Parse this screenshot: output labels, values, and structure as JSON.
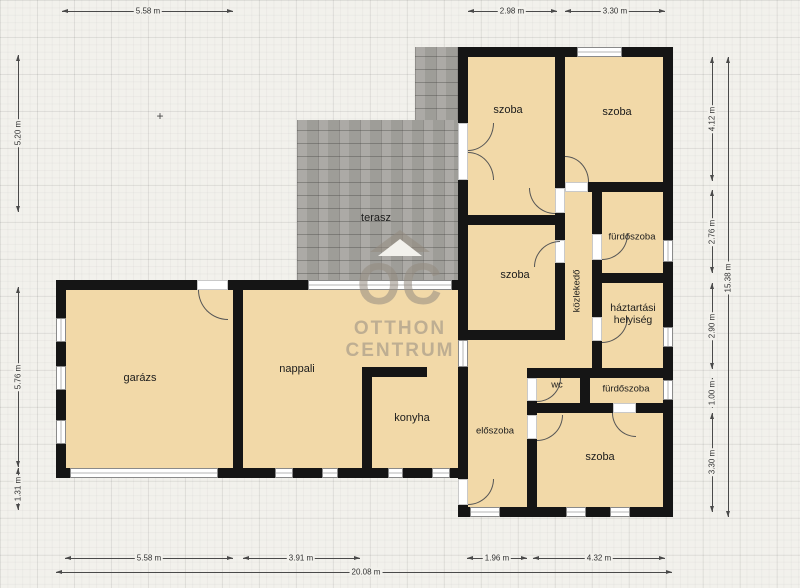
{
  "rooms": {
    "garazs": "garázs",
    "nappali": "nappali",
    "konyha": "konyha",
    "terasz": "terasz",
    "szoba_top_left": "szoba",
    "szoba_top_right": "szoba",
    "szoba_middle": "szoba",
    "szoba_bottom_right": "szoba",
    "furdoszoba_top": "fürdőszoba",
    "furdoszoba_bottom": "fürdőszoba",
    "haztartasi": "háztartási helyiség",
    "kozlekedo": "közlekedő",
    "wc": "wc",
    "eloszoba": "előszoba"
  },
  "dimensions": {
    "top": [
      "5.58 m",
      "2.98 m",
      "3.30 m"
    ],
    "left": [
      "5.20 m",
      "5.76 m",
      "1.31 m"
    ],
    "right": [
      "4.12 m",
      "2.76 m",
      "2.90 m",
      "1.00 m",
      "3.30 m"
    ],
    "right_total": "15.38 m",
    "bottom": [
      "5.58 m",
      "3.91 m",
      "1.96 m",
      "4.32 m"
    ],
    "bottom_total": "20.08 m"
  },
  "watermark": {
    "logo": "OC",
    "line1": "OTTHON",
    "line2": "CENTRUM"
  },
  "marker_plus": "+",
  "colors": {
    "wall": "#151515",
    "floor": "#f2d9a8",
    "terrace": "#a7a5a0",
    "background": "#f2f1ec",
    "watermark": "rgba(148,139,128,0.55)"
  }
}
